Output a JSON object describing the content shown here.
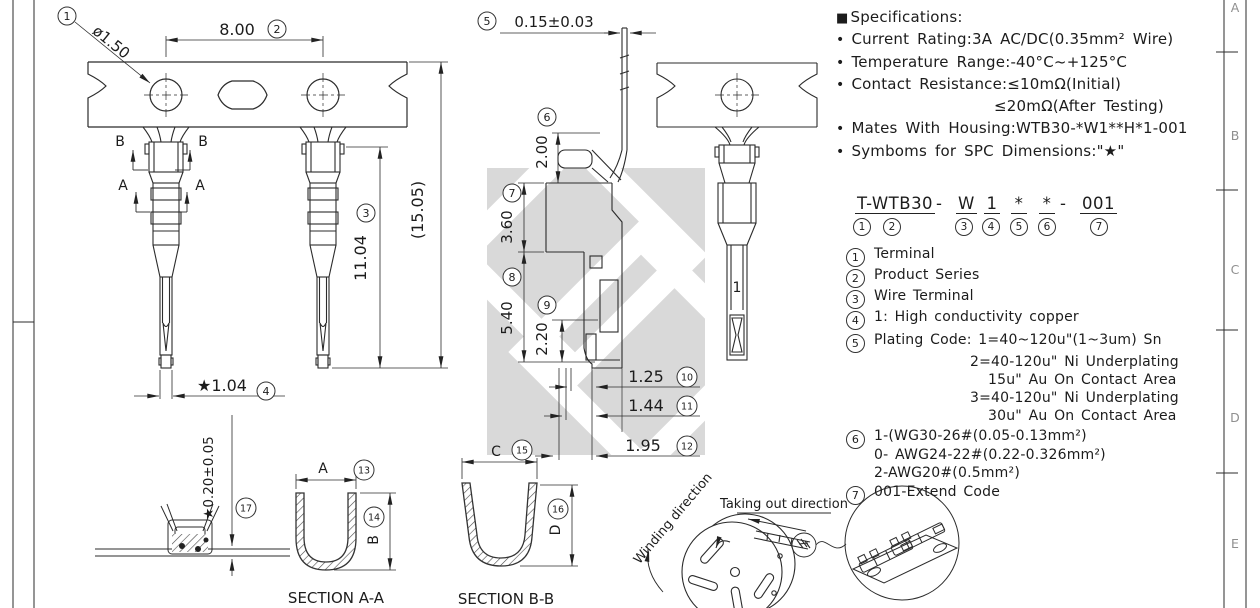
{
  "frame": {
    "zones": [
      "A",
      "B",
      "C",
      "D",
      "E"
    ]
  },
  "specs": {
    "square": "■",
    "title": "Specifications:",
    "bullet": "•",
    "lines": [
      "Current Rating:3A AC/DC(0.35mm² Wire)",
      "Temperature Range:-40°C~+125°C",
      "Contact Resistance:≤10mΩ(Initial)",
      "≤20mΩ(After Testing)",
      "Mates With Housing:WTB30-*W1**H*1-001",
      "Symboms for SPC Dimensions:\"★\""
    ]
  },
  "part_number": {
    "seg_t": "T-WTB30",
    "sep1": "-",
    "seg_w": "W",
    "seg_1": "1",
    "seg_s1": "*",
    "seg_s2": "*",
    "sep2": "-",
    "seg_001": "001",
    "n1": "1",
    "n2": "2",
    "n3": "3",
    "n4": "4",
    "n5": "5",
    "n6": "6",
    "n7": "7"
  },
  "legend": {
    "i1": {
      "num": "1",
      "text": "Terminal"
    },
    "i2": {
      "num": "2",
      "text": "Product Series"
    },
    "i3": {
      "num": "3",
      "text": "Wire Terminal"
    },
    "i4": {
      "num": "4",
      "text": "1: High conductivity copper"
    },
    "i5": {
      "num": "5",
      "text": "Plating Code: 1=40~120u\"(1~3um) Sn",
      "sub1": "2=40-120u\" Ni Underplating",
      "sub2": "15u\" Au On Contact Area",
      "sub3": "3=40-120u\" Ni Underplating",
      "sub4": "30u\" Au On Contact Area"
    },
    "i6": {
      "num": "6",
      "text": "1-(WG30-26#(0.05-0.13mm²)",
      "sub1": "0- AWG24-22#(0.22-0.326mm²)",
      "sub2": "2-AWG20#(0.5mm²)"
    },
    "i7": {
      "num": "7",
      "text": "001-Extend Code"
    }
  },
  "dims": {
    "d1": "ø1.50",
    "d2": "8.00",
    "d3": "11.04",
    "d3_ref": "(15.05)",
    "d4": "★1.04",
    "d5": "0.15±0.03",
    "d6": "2.00",
    "d7": "3.60",
    "d8": "5.40",
    "d9": "2.20",
    "d10": "1.25",
    "d11": "1.44",
    "d12": "1.95",
    "d13": "A",
    "d14": "B",
    "d15": "C",
    "d16": "D",
    "d17": "★0.20±0.05"
  },
  "callouts": {
    "c1": "1",
    "c2": "2",
    "c3": "3",
    "c4": "4",
    "c5": "5",
    "c6": "6",
    "c7": "7",
    "c8": "8",
    "c9": "9",
    "c10": "10",
    "c11": "11",
    "c12": "12",
    "c13": "13",
    "c14": "14",
    "c15": "15",
    "c16": "16",
    "c17": "17"
  },
  "marks": {
    "a": "A",
    "b": "B"
  },
  "sections": {
    "aa": "SECTION A-A",
    "bb": "SECTION B-B"
  },
  "reel": {
    "winding": "Winding direction",
    "takeout": "Taking out direction"
  },
  "views": {
    "rear_mark": "1"
  }
}
